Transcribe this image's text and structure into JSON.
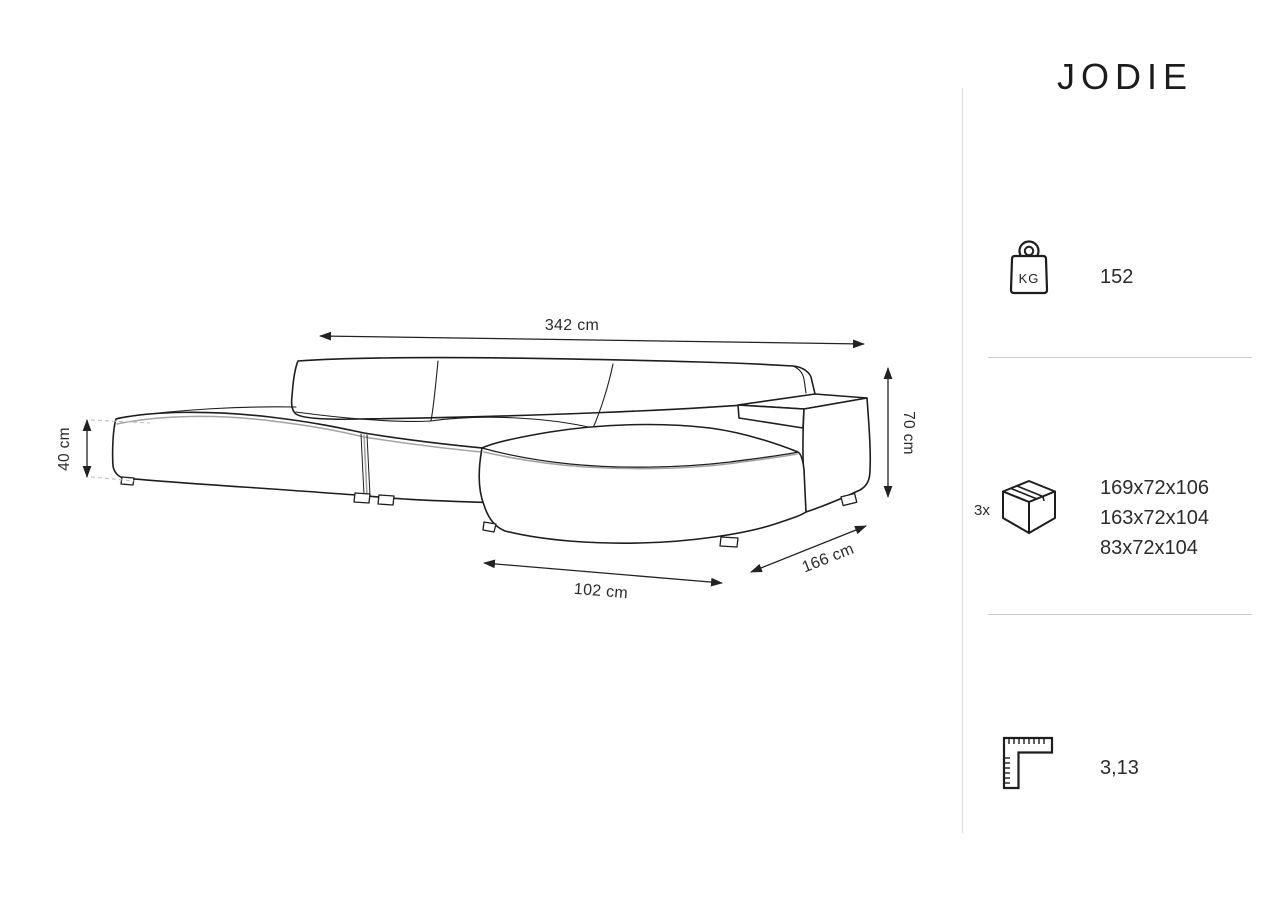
{
  "product": {
    "title": "JODIE"
  },
  "diagram": {
    "dimensions": {
      "total_width": {
        "label": "342 cm"
      },
      "seat_height": {
        "label": "40 cm"
      },
      "total_height": {
        "label": "70 cm"
      },
      "chaise_width": {
        "label": "102 cm"
      },
      "total_depth": {
        "label": "166 cm"
      }
    }
  },
  "specs": {
    "weight": {
      "icon": "weight-kg-icon",
      "unit_label": "KG",
      "value": "152"
    },
    "packages": {
      "icon": "package-box-icon",
      "count_label": "3x",
      "sizes": [
        "169x72x106",
        "163x72x104",
        "83x72x104"
      ]
    },
    "volume": {
      "icon": "ruler-icon",
      "value": "3,13"
    }
  },
  "colors": {
    "line": "#1d1d1d",
    "piping": "#a3a3a3",
    "divider": "#c9c9c9",
    "background": "#ffffff",
    "text": "#2b2b2b"
  }
}
